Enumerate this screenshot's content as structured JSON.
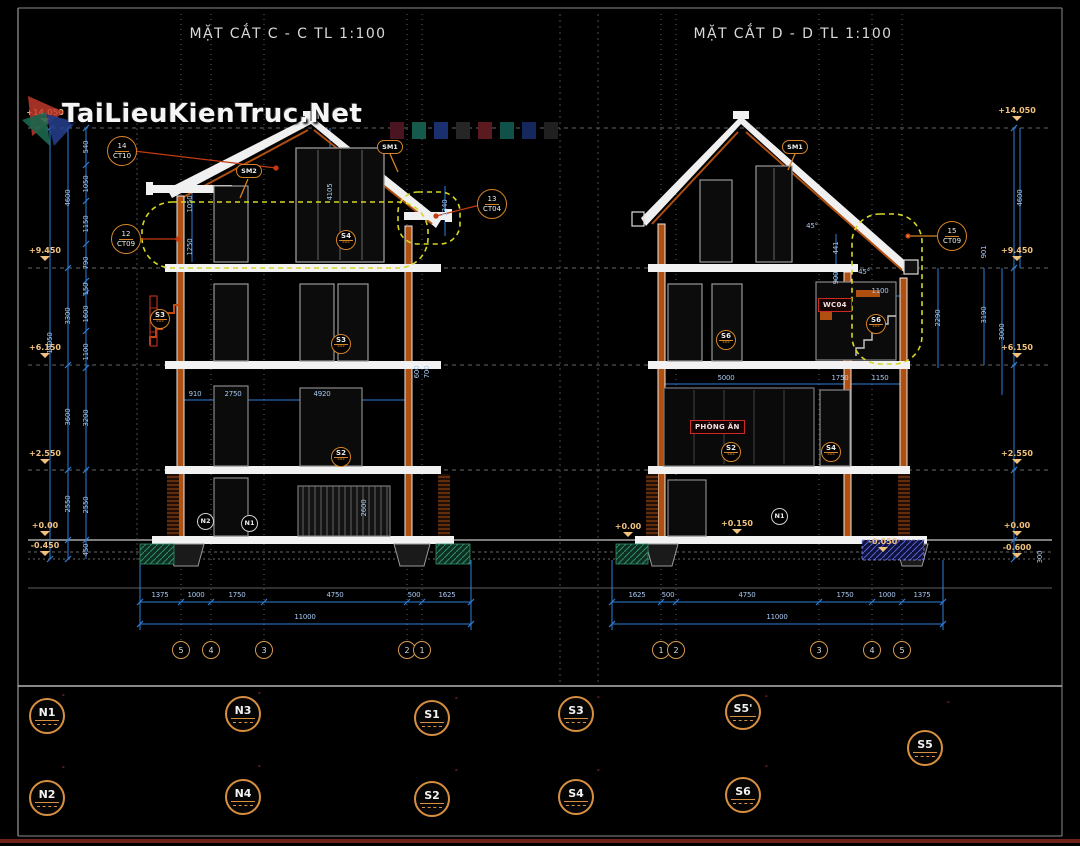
{
  "watermark": {
    "text": "TaiLieuKienTruc.Net"
  },
  "titles": {
    "section_c": "MẶT CẮT C - C TL 1:100",
    "section_d": "MẶT CẮT D - D TL 1:100"
  },
  "colors": {
    "dim_line": "#2f7fd9",
    "dim_text": "#a9c9f2",
    "elevation": "#f2c27e",
    "cloud": "#d6d622",
    "callout": "#d78428",
    "leader": "#c23a10",
    "wall": "#f0f0f0",
    "hatch": "#b05010",
    "title": "#d9d9d9"
  },
  "levels": {
    "left": [
      "+14.050",
      "+9.450",
      "+6.150",
      "+2.550",
      "+0.00",
      "-0.450"
    ],
    "right": [
      "+14.050",
      "+9.450",
      "+6.150",
      "+2.550",
      "+0.00",
      "-0.600"
    ],
    "base_extra": [
      "+0.00",
      "+0.150",
      "-0.050"
    ]
  },
  "grids": {
    "left": [
      "5",
      "4",
      "3",
      "2",
      "1"
    ],
    "right": [
      "1",
      "2",
      "3",
      "4",
      "5"
    ]
  },
  "dims": {
    "left_bottom": [
      "1375",
      "1000",
      "1750",
      "4750",
      "500",
      "1625"
    ],
    "right_bottom": [
      "1625",
      "500",
      "4750",
      "1750",
      "1000",
      "1375"
    ],
    "overall": "11000",
    "height_overall": "14050",
    "left_major": [
      "4600",
      "3300",
      "3600",
      "2550"
    ],
    "left_minor": [
      "540",
      "1050",
      "1150",
      "790",
      "150",
      "1600",
      "1100",
      "3200",
      "2550",
      "450"
    ],
    "right_side": [
      "901",
      "3190",
      "3000",
      "2290",
      "4600",
      "300"
    ],
    "interior_left": [
      "1050",
      "1250",
      "910",
      "2750",
      "4920",
      "600",
      "700",
      "2600",
      "1340",
      "4105"
    ],
    "interior_right": [
      "441",
      "900",
      "1100",
      "5000",
      "1750",
      "1150"
    ],
    "angle": "45°"
  },
  "callouts": {
    "ct10": {
      "num": "14",
      "ref": "CT10"
    },
    "ct09a": {
      "num": "12",
      "ref": "CT09"
    },
    "ct04": {
      "num": "13",
      "ref": "CT04"
    },
    "ct09b": {
      "num": "15",
      "ref": "CT09"
    },
    "sm1": "SM1",
    "sm2": "SM2",
    "floor_marks_left": [
      "S4",
      "S3",
      "S3",
      "S2"
    ],
    "floor_marks_right": [
      "S6",
      "S6",
      "S2",
      "S4"
    ],
    "base_marks_left": [
      "N2",
      "N1"
    ],
    "base_marks_right": [
      "N1"
    ]
  },
  "rooms": {
    "dining": "PHÒNG ĂN",
    "wc": "WC04"
  },
  "notes": [
    {
      "label": "N1",
      "lines": [
        "(LÁT GẠCH VIÊN 300X300 ĐỂ MẠCH 10 +VỮA LÁT) DÀY 40",
        "LỚP BÊ TÔNG NỀN DÀY 100",
        "LỚP MÀNG PLASTIC NGĂN HƠI NƯỚC",
        "LỚP BTGV #75 DÀY 100",
        "LỚP CÁT PHA ĐẤT TƯỚI NƯỚC ĐẦM KĨ TỪNG LỚP 200",
        "LỚP ĐẤT TỰ NHIÊN"
      ]
    },
    {
      "label": "N2",
      "lines": [
        "(BLOCK 4 VIÊN ĐẤT NUNG VIÊN 300X300 ĐỂ MẠCH 10",
        "BĂNG VIÊN BẰNG GỖ LIM +VỮA LÁT) DÀY 40",
        "LỚP BÊ TÔNG NỀN DÀY 100",
        "LỚP MÀNG PLASTIC NGĂN HƠI NƯỚC",
        "LỚP BTGV #75 DÀY 100",
        "LỚP CÁT PHA ĐẤT TƯỚI NƯỚC ĐẦM KĨ TỪNG LỚP 200",
        "LỚP ĐẤT TỰ NHIÊN"
      ]
    },
    {
      "label": "N3",
      "lines": [
        "(GẠCH CHỐNG TRƠN VIÊN 300X300 +VỮA LÁT) DÀY 40",
        "LỚP BÊ TÔNG NỀN DÀY 100",
        "LỚP MÀNG PLASTIC NGĂN HƠI NƯỚC",
        "LỚP BTGV #75 DÀY 100",
        "LỚP CÁT PHA ĐẤT TƯỚI NƯỚC ĐẦM KĨ TỪNG LỚP 200",
        "LỚP ĐẤT TỰ NHIÊN"
      ]
    },
    {
      "label": "N4",
      "lines": [
        "(GẠCH GRANITE VIÊN 300X300 +VỮA LÁT) DÀY 40",
        "LỚP BÊ TÔNG NỀN DÀY 100",
        "LỚP MÀNG PLASTIC NGĂN HƠI NƯỚC",
        "LỚP BTGV #75 DÀY 100",
        "LỚP CÁT PHA ĐẤT TƯỚI NƯỚC ĐẦM KĨ TỪNG LỚP 200",
        "LỚP ĐẤT TỰ NHIÊN"
      ]
    },
    {
      "label": "S1",
      "lines": [
        "(GẠCH GRANITE LÁT SÀN",
        "VIÊN 300X300 +VỮA LÁT) DÀY 40",
        "LỚP BTCT#250 DÀY 100",
        "LỚP VỮA TRÁT TRẦN #75 DÀY 15",
        "LĂN SƠN 3 NƯỚC MÀU TRẮNG"
      ]
    },
    {
      "label": "S2",
      "lines": [
        "(GẠCH GRANITE LÁT SÀN",
        "VIÊN 300X300 +VỮA LÁT) DÀY 40",
        "LỚP BTCT#250 DÀY 100",
        "LỚP VỮA TRÁT TRẦN #75 DÀY 15",
        "LĂN SƠN 3 NƯỚC MÀU TRẮNG"
      ]
    },
    {
      "label": "S3",
      "lines": [
        "(GẠCH LÁT SÀN VIÊN 450X450 +VỮA LÁT) DÀY 40",
        "LỚP BTCT#250 DÀY 100",
        "LỚP VỮA TRÁT TRẦN #75 DÀY 15",
        "LĂN SƠN 3 NƯỚC MÀU TRẮNG"
      ]
    },
    {
      "label": "S4",
      "lines": [
        "(GẠCH GRANITE GIẢ CỔ LÁT SÀN",
        "VIÊN 300X300 +VỮA LÁT) DÀY 40",
        "LỚP BTCT#250 DÀY 100",
        "LỚP VỮA TRÁT TRẦN #75 DÀY 15",
        "LĂN SƠN 3 NƯỚC MÀU TRẮNG"
      ]
    },
    {
      "label": "S5'",
      "lines": [
        "(ĐẶT GẠCH 300X300 ĐỂ MẠCH 10 +VỮA LÁT) DÀY 40",
        "LỚP XI MĂNG CÁT VÀNG",
        "BẢO VỆ CHỐNG THẤM",
        "LỚP CHỐNG THẤM SIKA",
        "LỚP SÀN BTCT"
      ]
    },
    {
      "label": "S6",
      "lines": [
        "LÁT GỖ GIÁNG HƯƠNG 900X900",
        "MẠCH ÂM DƯƠNG",
        "LỚP XƯƠNG GỖ",
        "LỚP BTCT#250 DÀY 100",
        "LỚP VỮA TRÁT TRẦN #75 DÀY 15",
        "LĂN SƠN 3 NƯỚC MÀU TRẮNG"
      ]
    },
    {
      "label": "S5",
      "lines": [
        "GẠCH VIÊN 300X300 DÀY 40",
        "KÊ ĐỂ MẠCH 10",
        "LỚP CỤC KÊ CT",
        "LỚP XI MĂNG CÁT VÀNG",
        "ĐÁNH DỐC VỀ GA THU NƯỚC",
        "BẢO VỆ LỚP CHỐNG THẤM",
        "LỚP CHỐNG THẤM SIKA QUÉT 3 LỚP",
        "LỚP SÀN BTCT#250 DÀY 100",
        "LỚP VỮA TRÁT#75 DÀY 15"
      ]
    }
  ]
}
